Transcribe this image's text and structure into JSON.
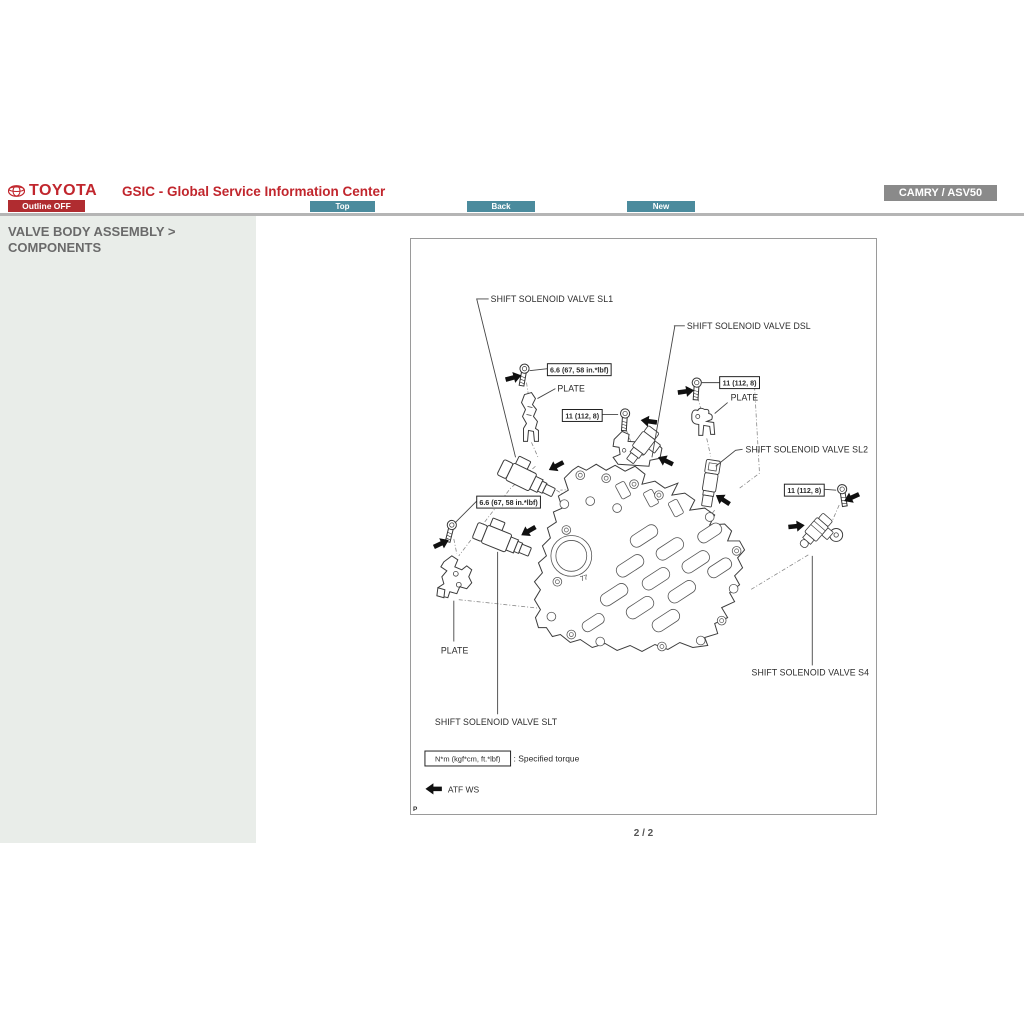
{
  "header": {
    "brand": "TOYOTA",
    "title": "GSIC - Global Service Information Center",
    "outline_button": "Outline OFF",
    "nav": [
      {
        "label": "Top"
      },
      {
        "label": "Back"
      },
      {
        "label": "New"
      }
    ],
    "vehicle_badge": "CAMRY / ASV50"
  },
  "sidebar": {
    "title_line1": "VALVE BODY ASSEMBLY >",
    "title_line2": "COMPONENTS"
  },
  "diagram": {
    "labels": {
      "sl1": "SHIFT SOLENOID VALVE SL1",
      "dsl": "SHIFT SOLENOID VALVE DSL",
      "sl2": "SHIFT SOLENOID VALVE SL2",
      "s4": "SHIFT SOLENOID VALVE S4",
      "slt": "SHIFT SOLENOID VALVE SLT",
      "plate": "PLATE"
    },
    "torque_values": {
      "bolt_66": "6.6 (67, 58 in.*lbf)",
      "bolt_11": "11 (112, 8)"
    },
    "legend": {
      "torque_unit_box": "N*m (kgf*cm, ft.*lbf)",
      "torque_caption": ": Specified torque",
      "atf_label": "ATF WS",
      "page_marker": "P"
    }
  },
  "footer": {
    "page_indicator": "2 / 2"
  },
  "colors": {
    "brand_red": "#c1262d",
    "button_red": "#b02c30",
    "button_teal": "#4b8b9d",
    "badge_gray": "#8a8a8a",
    "sidebar_bg": "#e9ede9"
  }
}
